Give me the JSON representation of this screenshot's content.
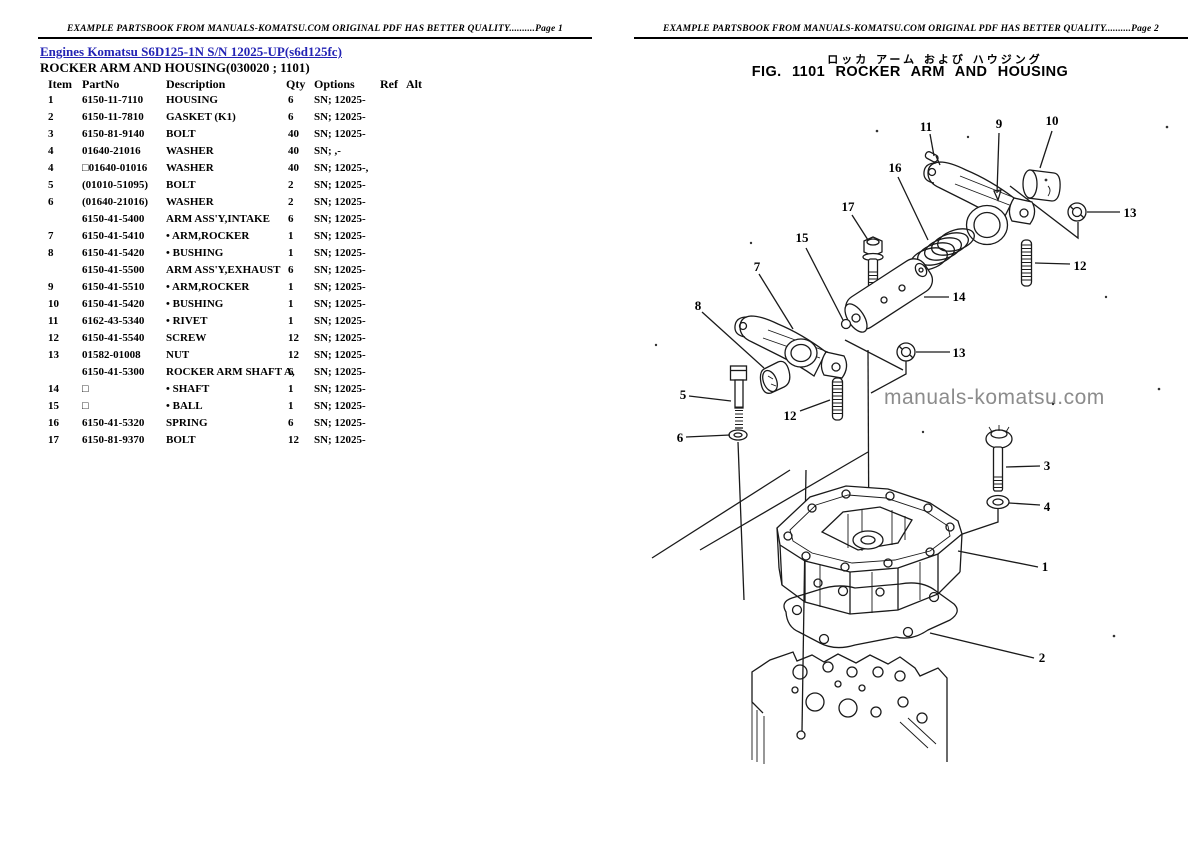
{
  "pages": {
    "left": {
      "header": "EXAMPLE PARTSBOOK FROM MANUALS-KOMATSU.COM ORIGINAL PDF HAS BETTER QUALITY..........Page 1",
      "breadcrumb": "Engines Komatsu S6D125-1N S/N 12025-UP(s6d125fc)",
      "section_title": "ROCKER ARM AND HOUSING(030020 ; 1101)",
      "table": {
        "headers": [
          "Item",
          "PartNo",
          "Description",
          "Qty",
          "Options",
          "Ref",
          "Alt"
        ],
        "rows": [
          {
            "item": "1",
            "part": "6150-11-7110",
            "desc": "HOUSING",
            "qty": "6",
            "opt": "SN; 12025-"
          },
          {
            "item": "2",
            "part": "6150-11-7810",
            "desc": "GASKET (K1)",
            "qty": "6",
            "opt": "SN; 12025-"
          },
          {
            "item": "3",
            "part": "6150-81-9140",
            "desc": "BOLT",
            "qty": "40",
            "opt": "SN; 12025-"
          },
          {
            "item": "4",
            "part": "01640-21016",
            "desc": "WASHER",
            "qty": "40",
            "opt": "SN; ,-"
          },
          {
            "item": "4",
            "part": "□01640-01016",
            "desc": "WASHER",
            "qty": "40",
            "opt": "SN; 12025-,"
          },
          {
            "item": "5",
            "part": "(01010-51095)",
            "desc": "BOLT",
            "qty": "2",
            "opt": "SN; 12025-"
          },
          {
            "item": "6",
            "part": "(01640-21016)",
            "desc": "WASHER",
            "qty": "2",
            "opt": "SN; 12025-"
          },
          {
            "item": "",
            "part": "6150-41-5400",
            "desc": "ARM ASS'Y,INTAKE",
            "qty": "6",
            "opt": "SN; 12025-"
          },
          {
            "item": "7",
            "part": "6150-41-5410",
            "desc": "• ARM,ROCKER",
            "qty": "1",
            "opt": "SN; 12025-"
          },
          {
            "item": "8",
            "part": "6150-41-5420",
            "desc": "• BUSHING",
            "qty": "1",
            "opt": "SN; 12025-"
          },
          {
            "item": "",
            "part": "6150-41-5500",
            "desc": "ARM ASS'Y,EXHAUST",
            "qty": "6",
            "opt": "SN; 12025-"
          },
          {
            "item": "9",
            "part": "6150-41-5510",
            "desc": "• ARM,ROCKER",
            "qty": "1",
            "opt": "SN; 12025-"
          },
          {
            "item": "10",
            "part": "6150-41-5420",
            "desc": "• BUSHING",
            "qty": "1",
            "opt": "SN; 12025-"
          },
          {
            "item": "11",
            "part": "6162-43-5340",
            "desc": "• RIVET",
            "qty": "1",
            "opt": "SN; 12025-"
          },
          {
            "item": "12",
            "part": "6150-41-5540",
            "desc": "SCREW",
            "qty": "12",
            "opt": "SN; 12025-"
          },
          {
            "item": "13",
            "part": "01582-01008",
            "desc": "NUT",
            "qty": "12",
            "opt": "SN; 12025-"
          },
          {
            "item": "",
            "part": "6150-41-5300",
            "desc": "ROCKER ARM SHAFT A,",
            "qty": "6",
            "opt": "SN; 12025-"
          },
          {
            "item": "14",
            "part": "□",
            "desc": "• SHAFT",
            "qty": "1",
            "opt": "SN; 12025-"
          },
          {
            "item": "15",
            "part": "□",
            "desc": "• BALL",
            "qty": "1",
            "opt": "SN; 12025-"
          },
          {
            "item": "16",
            "part": "6150-41-5320",
            "desc": "SPRING",
            "qty": "6",
            "opt": "SN; 12025-"
          },
          {
            "item": "17",
            "part": "6150-81-9370",
            "desc": "BOLT",
            "qty": "12",
            "opt": "SN; 12025-"
          }
        ]
      }
    },
    "right": {
      "header": "EXAMPLE PARTSBOOK FROM MANUALS-KOMATSU.COM ORIGINAL PDF HAS BETTER QUALITY..........Page 2",
      "title_jp": "ロッカ アーム および ハウジング",
      "fig_title": "FIG. 1101 ROCKER ARM AND HOUSING",
      "watermark": "manuals-komatsu.com",
      "diagram_callouts": [
        {
          "label": "11",
          "x": 926,
          "y": 131
        },
        {
          "label": "9",
          "x": 999,
          "y": 128
        },
        {
          "label": "10",
          "x": 1052,
          "y": 125
        },
        {
          "label": "16",
          "x": 895,
          "y": 172
        },
        {
          "label": "13",
          "x": 1130,
          "y": 217
        },
        {
          "label": "17",
          "x": 848,
          "y": 211
        },
        {
          "label": "15",
          "x": 802,
          "y": 242
        },
        {
          "label": "7",
          "x": 757,
          "y": 271
        },
        {
          "label": "12",
          "x": 1080,
          "y": 270
        },
        {
          "label": "14",
          "x": 959,
          "y": 301
        },
        {
          "label": "8",
          "x": 698,
          "y": 310
        },
        {
          "label": "13",
          "x": 959,
          "y": 357
        },
        {
          "label": "5",
          "x": 683,
          "y": 399
        },
        {
          "label": "12",
          "x": 790,
          "y": 420
        },
        {
          "label": "6",
          "x": 680,
          "y": 442
        },
        {
          "label": "3",
          "x": 1047,
          "y": 470
        },
        {
          "label": "4",
          "x": 1047,
          "y": 511
        },
        {
          "label": "1",
          "x": 1045,
          "y": 571
        },
        {
          "label": "2",
          "x": 1042,
          "y": 662
        }
      ]
    }
  },
  "colors": {
    "link_blue": "#2323b4",
    "ink": "#1a1a1a",
    "watermark_gray": "#8c8c8c"
  }
}
